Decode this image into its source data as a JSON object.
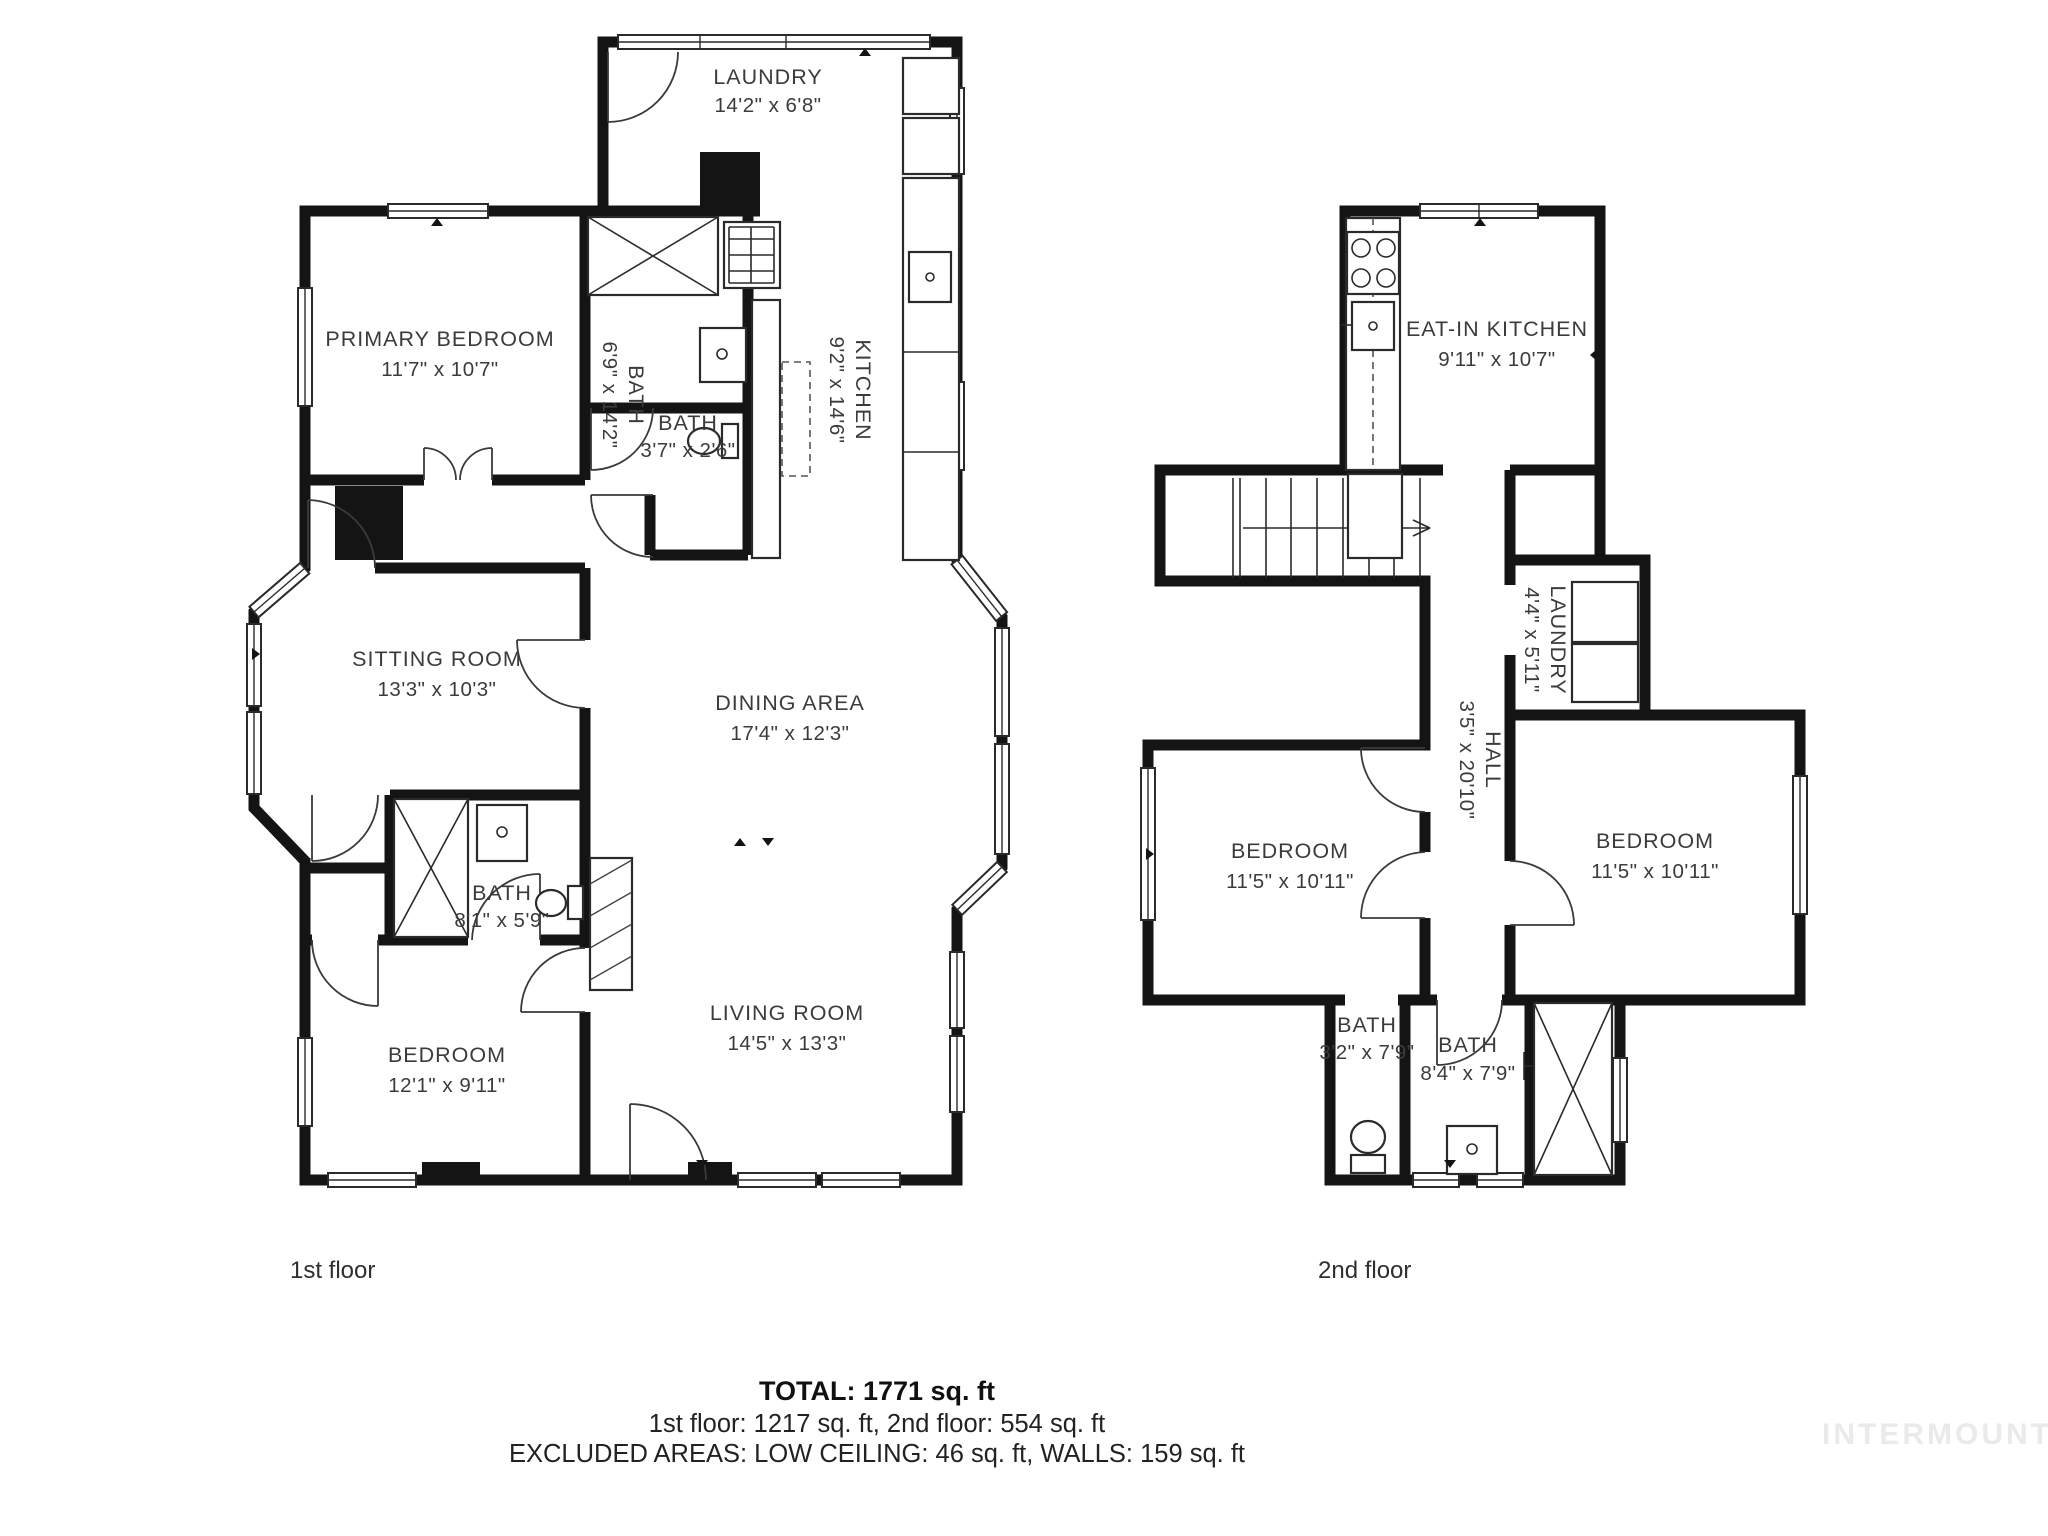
{
  "floor1": {
    "label": "1st floor",
    "rooms": {
      "laundry": {
        "name": "LAUNDRY",
        "dims": "14'2\" x 6'8\""
      },
      "primary_bedroom": {
        "name": "PRIMARY BEDROOM",
        "dims": "11'7\" x 10'7\""
      },
      "bath_main": {
        "name": "BATH",
        "dims": "6'9\" x 14'2\""
      },
      "bath_small": {
        "name": "BATH",
        "dims": "3'7\" x 2'6\""
      },
      "kitchen": {
        "name": "KITCHEN",
        "dims": "9'2\" x 14'6\""
      },
      "sitting_room": {
        "name": "SITTING ROOM",
        "dims": "13'3\" x 10'3\""
      },
      "dining_area": {
        "name": "DINING AREA",
        "dims": "17'4\" x 12'3\""
      },
      "bath_hall": {
        "name": "BATH",
        "dims": "8'1\" x 5'9\""
      },
      "bedroom": {
        "name": "BEDROOM",
        "dims": "12'1\" x 9'11\""
      },
      "living_room": {
        "name": "LIVING ROOM",
        "dims": "14'5\" x 13'3\""
      }
    }
  },
  "floor2": {
    "label": "2nd floor",
    "rooms": {
      "eat_in_kitchen": {
        "name": "EAT-IN KITCHEN",
        "dims": "9'11\" x 10'7\""
      },
      "laundry": {
        "name": "LAUNDRY",
        "dims": "4'4\" x 5'11\""
      },
      "hall": {
        "name": "HALL",
        "dims": "3'5\" x 20'10\""
      },
      "bedroom_left": {
        "name": "BEDROOM",
        "dims": "11'5\" x 10'11\""
      },
      "bedroom_right": {
        "name": "BEDROOM",
        "dims": "11'5\" x 10'11\""
      },
      "bath_left": {
        "name": "BATH",
        "dims": "3'2\" x 7'9\""
      },
      "bath_middle": {
        "name": "BATH",
        "dims": "8'4\" x 7'9\""
      }
    }
  },
  "summary": {
    "total": "TOTAL: 1771 sq. ft",
    "floors": "1st floor: 1217 sq. ft, 2nd floor: 554 sq. ft",
    "excluded": "EXCLUDED AREAS: LOW CEILING: 46 sq. ft, WALLS: 159 sq. ft"
  },
  "watermark": "INTERMOUNTAIN",
  "colors": {
    "wall": "#141414",
    "fixture_line": "#2a2a2a",
    "label_text": "#3b3b3b",
    "summary_text": "#111111",
    "watermark_text": "#eaeaea",
    "background": "#ffffff"
  }
}
